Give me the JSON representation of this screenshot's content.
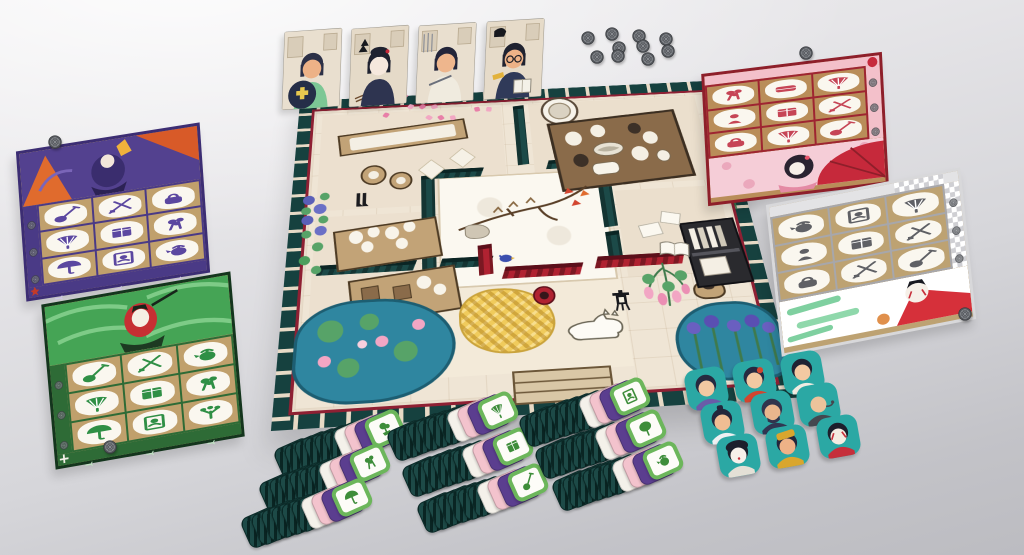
{
  "scene": {
    "label": "Japanese-themed board game tabletop setup",
    "background": {
      "top": "#efeef0",
      "bottom": "#bcbcc1"
    }
  },
  "character_cards": {
    "count": 4,
    "items": [
      {
        "id": "painter-boy",
        "skin": "#edb287",
        "hair": "#2c3047",
        "outfit": "#7cc795",
        "prop": "disc",
        "prop_color": "#252e48",
        "accent": "#e8c94f",
        "bg": "#e9dfcf"
      },
      {
        "id": "geisha",
        "skin": "#f6e8dd",
        "hair": "#1f2230",
        "outfit": "#2e3450",
        "prop": "stones",
        "prop_color": "#17191f",
        "accent": "#c6293b",
        "bg": "#e5dac8"
      },
      {
        "id": "craftswoman",
        "skin": "#eeb68d",
        "hair": "#23253a",
        "outfit": "#f0ebdf",
        "prop": "loom",
        "prop_color": "#8c8f97",
        "accent": "#6b707c",
        "bg": "#e9dfcf"
      },
      {
        "id": "scholar",
        "skin": "#edb287",
        "hair": "#1f2230",
        "outfit": "#303a59",
        "prop": "book",
        "prop_color": "#f4f1e8",
        "accent": "#e2b23c",
        "bg": "#e6dbc9"
      }
    ]
  },
  "coins": {
    "style": "dark-metal-rosette",
    "outer": "#55585d",
    "ring": "#989ba0",
    "line": "#36393d",
    "size": 14,
    "cluster": [
      [
        588,
        37
      ],
      [
        612,
        33
      ],
      [
        639,
        35
      ],
      [
        666,
        38
      ],
      [
        619,
        47
      ],
      [
        643,
        45
      ],
      [
        668,
        50
      ],
      [
        597,
        56
      ],
      [
        618,
        55
      ],
      [
        648,
        58
      ]
    ],
    "singles": [
      [
        806,
        52
      ],
      [
        55,
        141
      ],
      [
        110,
        446
      ],
      [
        965,
        313
      ]
    ]
  },
  "player_boards": [
    {
      "id": "purple",
      "frame": "#3c2d73",
      "band": "#53418f",
      "grid_bg": "#c0a06c",
      "cell_line": "#4a3a86",
      "item_color": "#5b47a0",
      "strip": "#4a3a86",
      "strip_icon": "#cfc6e8",
      "corner": "maple",
      "items": [
        "shamisen",
        "brush-set",
        "handbag",
        "fan",
        "kimono",
        "flowers",
        "umbrella",
        "portrait",
        "teapot"
      ],
      "layout": "band-top"
    },
    {
      "id": "green",
      "frame": "#14351d",
      "band": "#3f9e52",
      "grid_bg": "#c0a06c",
      "cell_line": "#2e6b36",
      "item_color": "#2f8f45",
      "strip": "#2e6b36",
      "strip_icon": "#bfe3c2",
      "corner": "cross",
      "items": [
        "shamisen",
        "brush-set",
        "teapot",
        "fan",
        "kimono",
        "flowers",
        "umbrella",
        "portrait",
        "plant"
      ],
      "layout": "band-top"
    },
    {
      "id": "red",
      "frame": "#8e1f2a",
      "band": "#f5cdd7",
      "grid_bg": "#b98d59",
      "cell_line": "#9e2531",
      "item_color": "#c64556",
      "strip": "#f3c0ca",
      "strip_icon": "#a43543",
      "corner": "seal",
      "items": [
        "flowers",
        "pillow",
        "fan",
        "figurine",
        "kimono",
        "brush-set",
        "handbag",
        "fan",
        "shamisen"
      ],
      "layout": "band-bottom"
    },
    {
      "id": "white",
      "frame": "#d8d8da",
      "band": "#ffffff",
      "grid_bg": "#bda272",
      "cell_line": "#a7a7ab",
      "item_color": "#5f6065",
      "strip": "#e3e3e5",
      "strip_icon": "#55585d",
      "corner": "checker",
      "items": [
        "teapot",
        "portrait",
        "fan",
        "figurine",
        "kimono",
        "brush-set",
        "handbag",
        "brush-set",
        "shamisen"
      ],
      "layout": "band-bottom"
    }
  ],
  "main_board": {
    "border_tile": "#16413f",
    "border_gap": "#e7dac6",
    "frame_red": "#8e2033",
    "floor": "#efe5d5",
    "garden": "#fbf8f0",
    "pond": "#2f86a0",
    "lily": "#57a368",
    "lotus": "#f2a6c4",
    "gold": "#f0cb5c",
    "wall_teal": "#1c4a48",
    "wall_red": "#b02231",
    "wood": "#c2a377",
    "rooms": [
      {
        "x": 26,
        "y": 24,
        "w": 196,
        "h": 134,
        "c": "#ece0cf"
      },
      {
        "x": 252,
        "y": 22,
        "w": 186,
        "h": 122,
        "c": "#ebdfcd"
      },
      {
        "x": 26,
        "y": 166,
        "w": 106,
        "h": 142,
        "c": "#ece0cf"
      },
      {
        "x": 332,
        "y": 152,
        "w": 108,
        "h": 108,
        "c": "#ebdfcd"
      },
      {
        "x": 134,
        "y": 258,
        "w": 190,
        "h": 100,
        "c": "#f3ead9"
      },
      {
        "x": 150,
        "y": 122,
        "w": 168,
        "h": 136,
        "c": "#fbf8f0",
        "garden": true
      }
    ],
    "walls": [
      {
        "c": "teal",
        "x": 133,
        "y": 118,
        "w": 14,
        "h": 126
      },
      {
        "c": "teal",
        "x": 316,
        "y": 112,
        "w": 14,
        "h": 86
      },
      {
        "c": "teal",
        "x": 147,
        "y": 111,
        "w": 50,
        "h": 12
      },
      {
        "c": "teal",
        "x": 266,
        "y": 106,
        "w": 52,
        "h": 12
      },
      {
        "c": "teal",
        "x": 235,
        "y": 24,
        "w": 12,
        "h": 86
      },
      {
        "c": "teal",
        "x": 32,
        "y": 226,
        "w": 94,
        "h": 12
      },
      {
        "c": "teal",
        "x": 151,
        "y": 226,
        "w": 50,
        "h": 12
      },
      {
        "c": "teal",
        "x": 316,
        "y": 204,
        "w": 14,
        "h": 40
      },
      {
        "c": "red",
        "x": 212,
        "y": 240,
        "w": 76,
        "h": 14
      },
      {
        "c": "red",
        "x": 303,
        "y": 234,
        "w": 86,
        "h": 14
      },
      {
        "c": "red",
        "x": 188,
        "y": 212,
        "w": 14,
        "h": 36
      }
    ],
    "props": [
      {
        "t": "bench",
        "x": 45,
        "y": 47,
        "w": 134,
        "h": 26,
        "r": -7
      },
      {
        "t": "stool",
        "x": 70,
        "y": 100,
        "w": 23,
        "h": 23
      },
      {
        "t": "stool",
        "x": 100,
        "y": 111,
        "w": 20,
        "h": 20
      },
      {
        "t": "cushion",
        "x": 134,
        "y": 100,
        "w": 18,
        "h": 18
      },
      {
        "t": "cushion",
        "x": 167,
        "y": 86,
        "w": 18,
        "h": 18
      },
      {
        "t": "boots",
        "x": 64,
        "y": 136,
        "w": 16,
        "h": 21
      },
      {
        "t": "bigbowl",
        "x": 265,
        "y": 14,
        "w": 42,
        "h": 42
      },
      {
        "t": "foodtable",
        "x": 274,
        "y": 47,
        "w": 136,
        "h": 91,
        "r": -5
      },
      {
        "t": "flowertable",
        "x": 47,
        "y": 179,
        "w": 100,
        "h": 46,
        "r": -7
      },
      {
        "t": "flowertable2",
        "x": 64,
        "y": 240,
        "w": 100,
        "h": 48,
        "r": -7
      },
      {
        "t": "branch",
        "x": 166,
        "y": 134,
        "w": 143,
        "h": 80
      },
      {
        "t": "rock",
        "x": 176,
        "y": 186,
        "w": 23,
        "h": 16
      },
      {
        "t": "bluebird",
        "x": 208,
        "y": 220,
        "w": 16,
        "h": 11
      },
      {
        "t": "pond",
        "x": 14,
        "y": 269,
        "w": 143,
        "h": 104
      },
      {
        "t": "goldpile",
        "x": 167,
        "y": 265,
        "w": 86,
        "h": 68
      },
      {
        "t": "redbowl",
        "x": 238,
        "y": 265,
        "w": 22,
        "h": 22
      },
      {
        "t": "fox",
        "x": 263,
        "y": 292,
        "w": 59,
        "h": 36
      },
      {
        "t": "lantern",
        "x": 312,
        "y": 274,
        "w": 20,
        "h": 25
      },
      {
        "t": "wisteria",
        "x": 339,
        "y": 244,
        "w": 57,
        "h": 55
      },
      {
        "t": "pot",
        "x": 392,
        "y": 269,
        "w": 27,
        "h": 18
      },
      {
        "t": "shelf",
        "x": 394,
        "y": 197,
        "w": 52,
        "h": 75,
        "r": -4
      },
      {
        "t": "book",
        "x": 366,
        "y": 220,
        "w": 32,
        "h": 20,
        "r": 8
      },
      {
        "t": "paper",
        "x": 351,
        "y": 197,
        "w": 20,
        "h": 14,
        "r": -10
      },
      {
        "t": "paper",
        "x": 374,
        "y": 184,
        "w": 18,
        "h": 13,
        "r": 14
      },
      {
        "t": "irises",
        "x": 366,
        "y": 295,
        "w": 94,
        "h": 78
      },
      {
        "t": "hydrangea",
        "x": 8,
        "y": 131,
        "w": 36,
        "h": 107
      },
      {
        "t": "ivy",
        "x": 441,
        "y": 45,
        "w": 23,
        "h": 143
      },
      {
        "t": "petals",
        "x": 86,
        "y": -5,
        "w": 134,
        "h": 54
      },
      {
        "t": "maple",
        "x": 278,
        "y": 143,
        "w": 36,
        "h": 27
      },
      {
        "t": "steps",
        "x": 213,
        "y": 356,
        "w": 86,
        "h": 30
      }
    ]
  },
  "tile_stacks": {
    "back_color": "#1d4a47",
    "edge_colors": [
      "#f4f1ea",
      "#f3c3cd",
      "#5b3e8f"
    ],
    "top_frame": "#6cb65b",
    "glyph_color": "#3e8d3a",
    "backs_per_stack": 6,
    "stacks": [
      {
        "x": 385,
        "y": 428,
        "item": "bonsai"
      },
      {
        "x": 370,
        "y": 462,
        "item": "flowers"
      },
      {
        "x": 352,
        "y": 497,
        "item": "umbrella"
      },
      {
        "x": 498,
        "y": 410,
        "item": "fan"
      },
      {
        "x": 513,
        "y": 446,
        "item": "kimono"
      },
      {
        "x": 528,
        "y": 482,
        "item": "shamisen"
      },
      {
        "x": 630,
        "y": 396,
        "item": "portrait"
      },
      {
        "x": 646,
        "y": 428,
        "item": "round-fan"
      },
      {
        "x": 663,
        "y": 460,
        "item": "teapot"
      }
    ]
  },
  "character_tokens": {
    "bg": "#2ba8a4",
    "items": [
      {
        "id": "maid",
        "skin": "#f3c9a2",
        "hair": "#262a40",
        "accent": "#6a5ba8",
        "pos": [
          706,
          388
        ]
      },
      {
        "id": "child",
        "skin": "#f3c9a2",
        "hair": "#262a40",
        "accent": "#d2452f",
        "pos": [
          754,
          380
        ]
      },
      {
        "id": "lady-white",
        "skin": "#f3c9a2",
        "hair": "#1f2233",
        "accent": "#f1ece2",
        "pos": [
          802,
          372
        ]
      },
      {
        "id": "samurai-topknot",
        "skin": "#f0bd93",
        "hair": "#23263b",
        "accent": "#eef0f2",
        "pos": [
          722,
          422
        ]
      },
      {
        "id": "bearded-man",
        "skin": "#e9b68d",
        "hair": "#30344d",
        "accent": "#303652",
        "pos": [
          772,
          412
        ]
      },
      {
        "id": "old-monk",
        "skin": "#ecc39b",
        "hair": "",
        "accent": "#44484f",
        "pos": [
          818,
          404
        ]
      },
      {
        "id": "geisha",
        "skin": "#f7f0ea",
        "hair": "#1d1f2c",
        "accent": "#e4e0d6",
        "pos": [
          738,
          455
        ]
      },
      {
        "id": "gold-hat-man",
        "skin": "#eeb287",
        "hair": "#23263b",
        "accent": "#d9a62e",
        "pos": [
          787,
          446
        ]
      },
      {
        "id": "kabuki-actor",
        "skin": "#f4ece2",
        "hair": "#1d1f2c",
        "accent": "#c62f3b",
        "pos": [
          838,
          436
        ]
      }
    ]
  }
}
